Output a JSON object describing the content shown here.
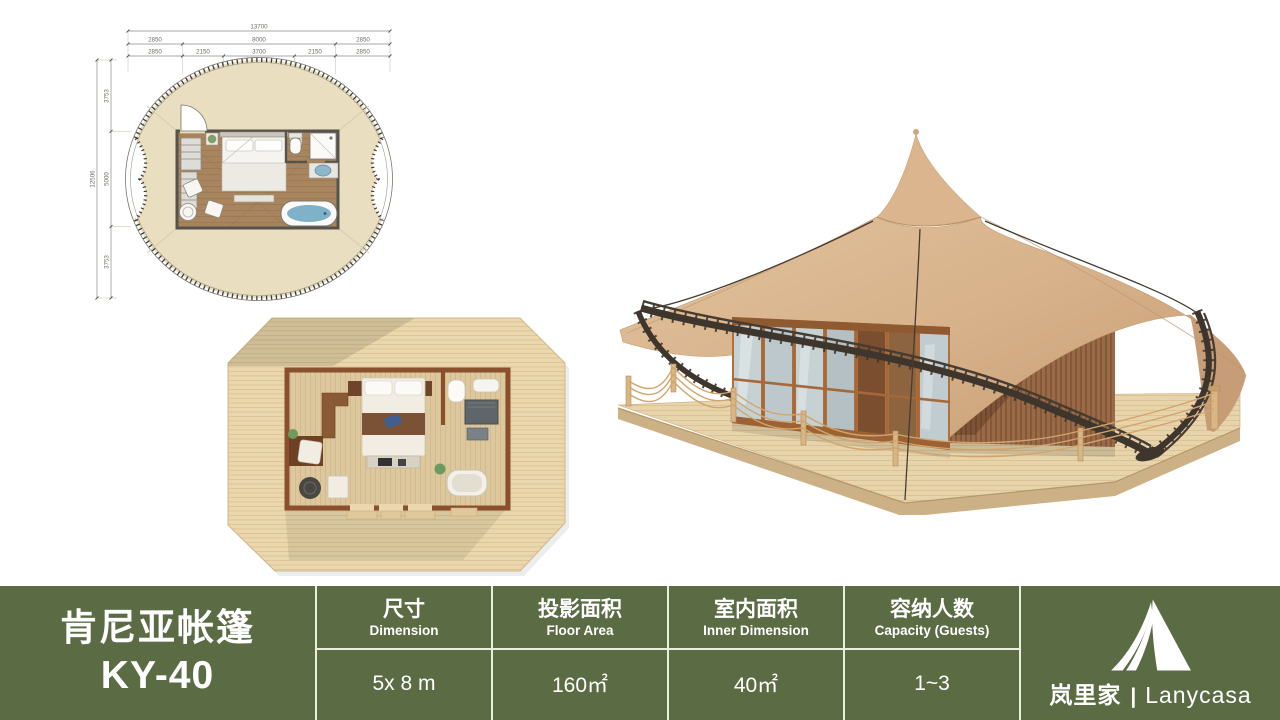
{
  "slide": {
    "background": "#ffffff"
  },
  "product": {
    "name_cn": "肯尼亚帐篷",
    "model": "KY-40"
  },
  "spec_table": {
    "bar_color": "#5b6c45",
    "divider_color": "#e9eedd",
    "text_color": "#ffffff",
    "columns": [
      {
        "label_cn": "尺寸",
        "label_en": "Dimension",
        "value": "5x 8 m"
      },
      {
        "label_cn": "投影面积",
        "label_en": "Floor Area",
        "value": "160㎡"
      },
      {
        "label_cn": "室内面积",
        "label_en": "Inner Dimension",
        "value": "40㎡"
      },
      {
        "label_cn": "容纳人数",
        "label_en": "Capacity (Guests)",
        "value": "1~3"
      }
    ]
  },
  "brand": {
    "name_cn": "岚里家",
    "separator": "|",
    "name_en": "Lanycasa",
    "icon": "tent-icon"
  },
  "floor_plan": {
    "dims_top": {
      "total": "13700",
      "row2": [
        "2850",
        "8000",
        "2850"
      ],
      "row3": [
        "2850",
        "2150",
        "3700",
        "2150",
        "2850"
      ]
    },
    "dims_left": {
      "total": "12506",
      "segments": [
        "3753",
        "5000",
        "3753"
      ]
    },
    "colors": {
      "canvas": "#e9dec0",
      "floor": "#a9855f"
    }
  }
}
